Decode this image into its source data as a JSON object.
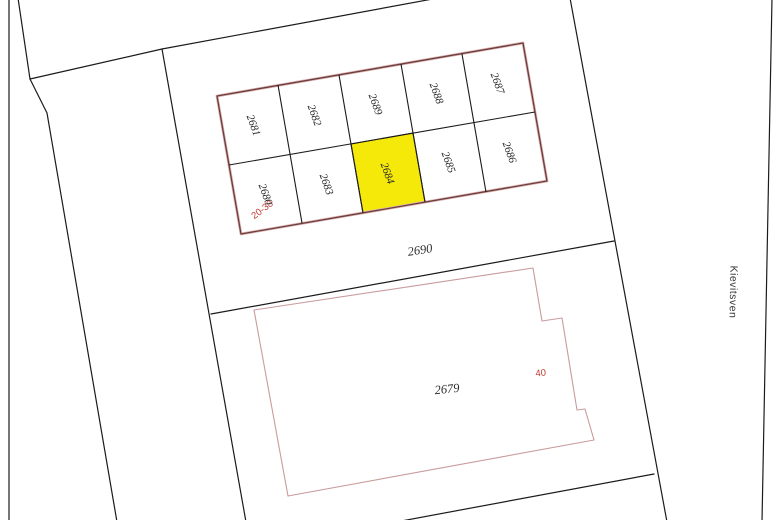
{
  "map": {
    "title": "cadastral-parcel-map",
    "street": {
      "name": "Kievitsven"
    },
    "parcels": {
      "row_top": [
        "2681",
        "2682",
        "2689",
        "2688",
        "2687"
      ],
      "row_bottom": [
        "2680",
        "2683",
        "2684",
        "2685",
        "2686"
      ],
      "strip": "2690",
      "large": "2679"
    },
    "highlighted_parcel": "2684",
    "annotations": {
      "house_range": "20-38",
      "house_number": "40"
    },
    "colors": {
      "highlight": "#F5E90A",
      "block_outline": "#6F3C3C",
      "large_parcel_outline": "#C99C9C",
      "boundary": "#1B1B1B",
      "annotation_red": "#C23B33"
    }
  }
}
